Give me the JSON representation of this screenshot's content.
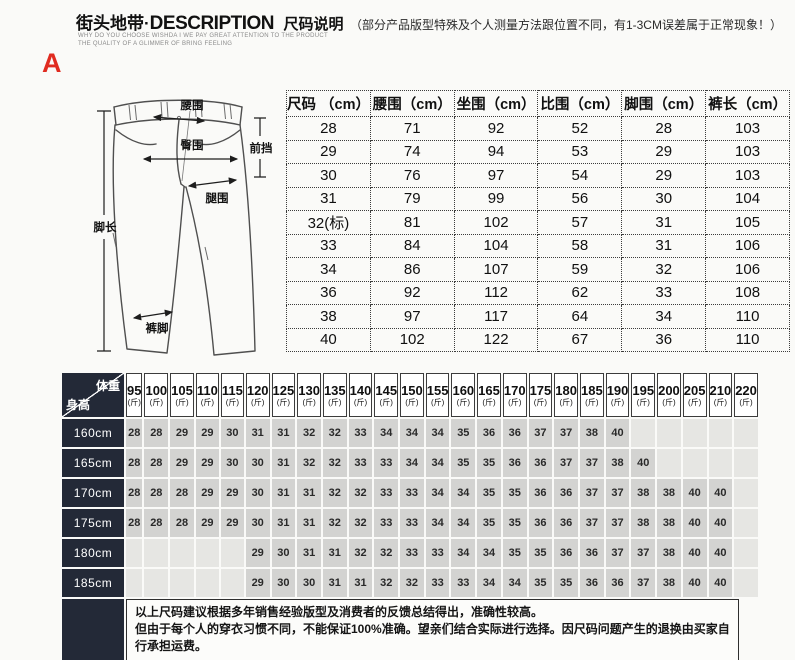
{
  "banner": {
    "brand": "街头地带",
    "separator": "·",
    "title_en": "DESCRIPTION",
    "title_cn": "尺码说明",
    "note": "（部分产品版型特殊及个人测量方法跟位置不同，有1-3CM误差属于正常现象！）",
    "sub_line1": "WHY DO YOU CHOOSE WISHDA I WE PAY GREAT ATTENTION TO THE PRODUCT",
    "sub_line2": "THE QUALITY OF A GLIMMER OF BRING FEELING",
    "marker": "A"
  },
  "diagram": {
    "labels": {
      "waist": "腰围",
      "hip": "臀围",
      "front_rise": "前挡",
      "thigh": "腿围",
      "leg_length": "脚长",
      "hem": "裤脚"
    }
  },
  "size_table": {
    "headers": [
      "尺码 （cm）",
      "腰围（cm）",
      "坐围（cm）",
      "比围（cm）",
      "脚围（cm）",
      "裤长（cm）"
    ],
    "rows": [
      [
        "28",
        "71",
        "92",
        "52",
        "28",
        "103"
      ],
      [
        "29",
        "74",
        "94",
        "53",
        "29",
        "103"
      ],
      [
        "30",
        "76",
        "97",
        "54",
        "29",
        "103"
      ],
      [
        "31",
        "79",
        "99",
        "56",
        "30",
        "104"
      ],
      [
        "32(标)",
        "81",
        "102",
        "57",
        "31",
        "105"
      ],
      [
        "33",
        "84",
        "104",
        "58",
        "31",
        "106"
      ],
      [
        "34",
        "86",
        "107",
        "59",
        "32",
        "106"
      ],
      [
        "36",
        "92",
        "112",
        "62",
        "33",
        "108"
      ],
      [
        "38",
        "97",
        "117",
        "64",
        "34",
        "110"
      ],
      [
        "40",
        "102",
        "122",
        "67",
        "36",
        "110"
      ]
    ]
  },
  "fit_table": {
    "corner_top": "体重",
    "corner_bottom": "身高",
    "weight_unit": "(斤)",
    "weights": [
      "95",
      "100",
      "105",
      "110",
      "115",
      "120",
      "125",
      "130",
      "135",
      "140",
      "145",
      "150",
      "155",
      "160",
      "165",
      "170",
      "175",
      "180",
      "185",
      "190",
      "195",
      "200",
      "205",
      "210",
      "220"
    ],
    "rows": [
      {
        "height": "160cm",
        "values": [
          "28",
          "28",
          "29",
          "29",
          "30",
          "31",
          "31",
          "32",
          "32",
          "33",
          "34",
          "34",
          "34",
          "35",
          "36",
          "36",
          "37",
          "37",
          "38",
          "40",
          "",
          "",
          "",
          "",
          ""
        ]
      },
      {
        "height": "165cm",
        "values": [
          "28",
          "28",
          "29",
          "29",
          "30",
          "30",
          "31",
          "32",
          "32",
          "33",
          "33",
          "34",
          "34",
          "35",
          "35",
          "36",
          "36",
          "37",
          "37",
          "38",
          "40",
          "",
          "",
          "",
          ""
        ]
      },
      {
        "height": "170cm",
        "values": [
          "28",
          "28",
          "28",
          "29",
          "29",
          "30",
          "31",
          "31",
          "32",
          "32",
          "33",
          "33",
          "34",
          "34",
          "35",
          "35",
          "36",
          "36",
          "37",
          "37",
          "38",
          "38",
          "40",
          "40",
          ""
        ]
      },
      {
        "height": "175cm",
        "values": [
          "28",
          "28",
          "28",
          "29",
          "29",
          "30",
          "31",
          "31",
          "32",
          "32",
          "33",
          "33",
          "34",
          "34",
          "35",
          "35",
          "36",
          "36",
          "37",
          "37",
          "38",
          "38",
          "40",
          "40",
          ""
        ]
      },
      {
        "height": "180cm",
        "values": [
          "",
          "",
          "",
          "",
          "",
          "29",
          "30",
          "31",
          "31",
          "32",
          "32",
          "33",
          "33",
          "34",
          "34",
          "35",
          "35",
          "36",
          "36",
          "37",
          "37",
          "38",
          "40",
          "40",
          ""
        ]
      },
      {
        "height": "185cm",
        "values": [
          "",
          "",
          "",
          "",
          "",
          "29",
          "30",
          "30",
          "31",
          "31",
          "32",
          "32",
          "33",
          "33",
          "34",
          "34",
          "35",
          "35",
          "36",
          "36",
          "37",
          "38",
          "40",
          "40",
          ""
        ]
      }
    ]
  },
  "notes": [
    "以上尺码建议根据多年销售经验版型及消费者的反馈总结得出，准确性较高。",
    "但由于每个人的穿衣习惯不同，不能保证100%准确。望亲们结合实际进行选择。因尺码问题产生的退换由买家自行承担运费。"
  ],
  "colors": {
    "accent_red": "#e02b20",
    "dark_cell": "#232937",
    "filled_cell": "#d3d3d1",
    "empty_cell": "#e6e6e3"
  }
}
